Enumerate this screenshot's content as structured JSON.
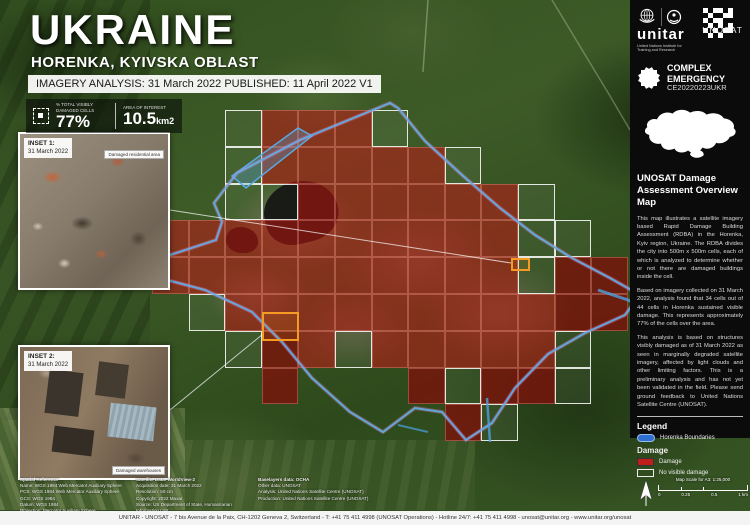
{
  "header": {
    "title": "UKRAINE",
    "subtitle": "HORENKA, KYIVSKA OBLAST",
    "analysis_bar": "IMAGERY ANALYSIS: 31 March 2022 PUBLISHED: 11 April 2022 V1"
  },
  "stats": {
    "damaged_cells_label": "% TOTAL VISIBLY DAMAGED CELLS",
    "damaged_cells_value": "77%",
    "area_label": "AREA OF INTEREST",
    "area_value": "10.5",
    "area_unit": "km2"
  },
  "insets": [
    {
      "label": "INSET 1:",
      "date": "31 March 2022",
      "callout": "Damaged residential area"
    },
    {
      "label": "INSET 2:",
      "date": "31 March 2022",
      "callout": "Damaged warehouses"
    }
  ],
  "sidebar": {
    "unitar_wordmark": "unitar",
    "unitar_subtext": "United Nations Institute for Training and Research",
    "unosat_wordmark": "UNOSAT",
    "emergency_line1": "COMPLEX",
    "emergency_line2": "EMERGENCY",
    "emergency_code": "CE20220223UKR",
    "heading": "UNOSAT Damage Assessment Overview Map",
    "paragraphs": [
      "This map illustrates a satellite imagery based Rapid Damage Building Assessment (RDBA) in the Horenka, Kyiv region, Ukraine. The RDBA divides the city into 500m x 500m cells, each of which is analyzed to determine whether or not there are damaged buildings inside the cell.",
      "Based on imagery collected on 31 March 2022, analysis found that 34 cells out of 44 cells in Horenka sustained visible damage. This represents approximately 77% of the cells over the area.",
      "This analysis is based on structures visibly damaged as of 31 March 2022 as seen in marginally degraded satellite imagery, affected by light clouds and other limiting factors. This is a preliminary analysis and has not yet been validated in the field. Please send ground feedback to United Nations Satellite Centre (UNOSAT)."
    ],
    "legend": {
      "title": "Legend",
      "boundary_label": "Horenka Boundaries",
      "damage_title": "Damage",
      "damage_label": "Damage",
      "no_damage_label": "No visible damage"
    }
  },
  "scalebar": {
    "title": "Map Scale for A3: 1:25,000",
    "ticks": [
      "0",
      "0.25",
      "0.5",
      "1 km"
    ]
  },
  "credits": {
    "columns": [
      {
        "x": 20,
        "lines": [
          "Spatial Reference",
          "Name: WGS 1984 Web Mercator Auxiliary Sphere",
          "PCS: WGS 1984 Web Mercator Auxiliary Sphere",
          "GCS: WGS 1984",
          "Datum: WGS 1984",
          "Projection: Mercator Auxiliary Sphere"
        ]
      },
      {
        "x": 136,
        "lines": [
          "Satellite Data: WorldView-2",
          "Acquisition date: 31 March 2022",
          "Resolution: 50 cm",
          "Copyright: 2022 Maxar",
          "Source: US Department of State, Humanitarian Information Unit"
        ]
      },
      {
        "x": 258,
        "lines": [
          "Baselayers data: OCHA",
          "Other data: UNOSAT",
          "Analysis: United Nations Satellite Centre (UNOSAT)",
          "Production: United Nations Satellite Centre (UNOSAT)"
        ]
      }
    ]
  },
  "footer": "UNITAR - UNOSAT - 7 bis Avenue de la Paix, CH-1202 Geneva 2, Switzerland - T: +41 75 411 4998 (UNOSAT Operations) - Hotline 24/7: +41 75 411 4998 - unosat@unitar.org - www.unitar.org/unosat",
  "map": {
    "colors": {
      "damage_fill": "#ba1c16",
      "damage_dark_fill": "#840c09",
      "no_damage_border": "#ffffff",
      "boundary_blue": "#5fb0e8",
      "inset_source_orange": "#f59a23"
    },
    "grid": {
      "x0": 152,
      "y0": 110,
      "cell_w": 36.6,
      "cell_h": 36.8,
      "cells": [
        {
          "c": 2,
          "r": 0,
          "t": "n"
        },
        {
          "c": 3,
          "r": 0,
          "t": "d"
        },
        {
          "c": 4,
          "r": 0,
          "t": "d"
        },
        {
          "c": 5,
          "r": 0,
          "t": "d"
        },
        {
          "c": 6,
          "r": 0,
          "t": "n"
        },
        {
          "c": 2,
          "r": 1,
          "t": "n"
        },
        {
          "c": 3,
          "r": 1,
          "t": "d"
        },
        {
          "c": 4,
          "r": 1,
          "t": "d"
        },
        {
          "c": 5,
          "r": 1,
          "t": "d"
        },
        {
          "c": 6,
          "r": 1,
          "t": "d"
        },
        {
          "c": 7,
          "r": 1,
          "t": "d"
        },
        {
          "c": 8,
          "r": 1,
          "t": "n"
        },
        {
          "c": 2,
          "r": 2,
          "t": "n"
        },
        {
          "c": 3,
          "r": 2,
          "t": "n"
        },
        {
          "c": 4,
          "r": 2,
          "t": "d"
        },
        {
          "c": 5,
          "r": 2,
          "t": "d"
        },
        {
          "c": 6,
          "r": 2,
          "t": "d"
        },
        {
          "c": 7,
          "r": 2,
          "t": "d"
        },
        {
          "c": 8,
          "r": 2,
          "t": "d"
        },
        {
          "c": 9,
          "r": 2,
          "t": "d"
        },
        {
          "c": 10,
          "r": 2,
          "t": "n"
        },
        {
          "c": 0,
          "r": 3,
          "t": "d"
        },
        {
          "c": 1,
          "r": 3,
          "t": "d"
        },
        {
          "c": 2,
          "r": 3,
          "t": "d"
        },
        {
          "c": 3,
          "r": 3,
          "t": "d"
        },
        {
          "c": 4,
          "r": 3,
          "t": "d"
        },
        {
          "c": 5,
          "r": 3,
          "t": "d"
        },
        {
          "c": 6,
          "r": 3,
          "t": "d"
        },
        {
          "c": 7,
          "r": 3,
          "t": "d"
        },
        {
          "c": 8,
          "r": 3,
          "t": "d"
        },
        {
          "c": 9,
          "r": 3,
          "t": "d"
        },
        {
          "c": 10,
          "r": 3,
          "t": "n"
        },
        {
          "c": 11,
          "r": 3,
          "t": "n"
        },
        {
          "c": 0,
          "r": 4,
          "t": "d"
        },
        {
          "c": 1,
          "r": 4,
          "t": "d"
        },
        {
          "c": 2,
          "r": 4,
          "t": "d"
        },
        {
          "c": 3,
          "r": 4,
          "t": "d"
        },
        {
          "c": 4,
          "r": 4,
          "t": "d"
        },
        {
          "c": 5,
          "r": 4,
          "t": "d"
        },
        {
          "c": 6,
          "r": 4,
          "t": "d"
        },
        {
          "c": 7,
          "r": 4,
          "t": "d"
        },
        {
          "c": 8,
          "r": 4,
          "t": "d"
        },
        {
          "c": 9,
          "r": 4,
          "t": "d"
        },
        {
          "c": 10,
          "r": 4,
          "t": "n"
        },
        {
          "c": 11,
          "r": 4,
          "t": "d",
          "k": 1
        },
        {
          "c": 12,
          "r": 4,
          "t": "d",
          "k": 1
        },
        {
          "c": 1,
          "r": 5,
          "t": "n"
        },
        {
          "c": 2,
          "r": 5,
          "t": "d"
        },
        {
          "c": 3,
          "r": 5,
          "t": "d"
        },
        {
          "c": 4,
          "r": 5,
          "t": "d"
        },
        {
          "c": 5,
          "r": 5,
          "t": "d"
        },
        {
          "c": 6,
          "r": 5,
          "t": "d"
        },
        {
          "c": 7,
          "r": 5,
          "t": "d"
        },
        {
          "c": 8,
          "r": 5,
          "t": "d"
        },
        {
          "c": 9,
          "r": 5,
          "t": "d"
        },
        {
          "c": 10,
          "r": 5,
          "t": "d"
        },
        {
          "c": 11,
          "r": 5,
          "t": "d",
          "k": 1
        },
        {
          "c": 12,
          "r": 5,
          "t": "d",
          "k": 1
        },
        {
          "c": 2,
          "r": 6,
          "t": "n"
        },
        {
          "c": 3,
          "r": 6,
          "t": "d",
          "k": 1
        },
        {
          "c": 4,
          "r": 6,
          "t": "d"
        },
        {
          "c": 5,
          "r": 6,
          "t": "n"
        },
        {
          "c": 6,
          "r": 6,
          "t": "d"
        },
        {
          "c": 7,
          "r": 6,
          "t": "d"
        },
        {
          "c": 8,
          "r": 6,
          "t": "d"
        },
        {
          "c": 9,
          "r": 6,
          "t": "d"
        },
        {
          "c": 10,
          "r": 6,
          "t": "d"
        },
        {
          "c": 11,
          "r": 6,
          "t": "n"
        },
        {
          "c": 3,
          "r": 7,
          "t": "d",
          "k": 1
        },
        {
          "c": 7,
          "r": 7,
          "t": "d",
          "k": 1
        },
        {
          "c": 8,
          "r": 7,
          "t": "n"
        },
        {
          "c": 9,
          "r": 7,
          "t": "d",
          "k": 1
        },
        {
          "c": 10,
          "r": 7,
          "t": "d",
          "k": 1
        },
        {
          "c": 11,
          "r": 7,
          "t": "n"
        },
        {
          "c": 8,
          "r": 8,
          "t": "d",
          "k": 1
        },
        {
          "c": 9,
          "r": 8,
          "t": "n"
        }
      ]
    }
  }
}
